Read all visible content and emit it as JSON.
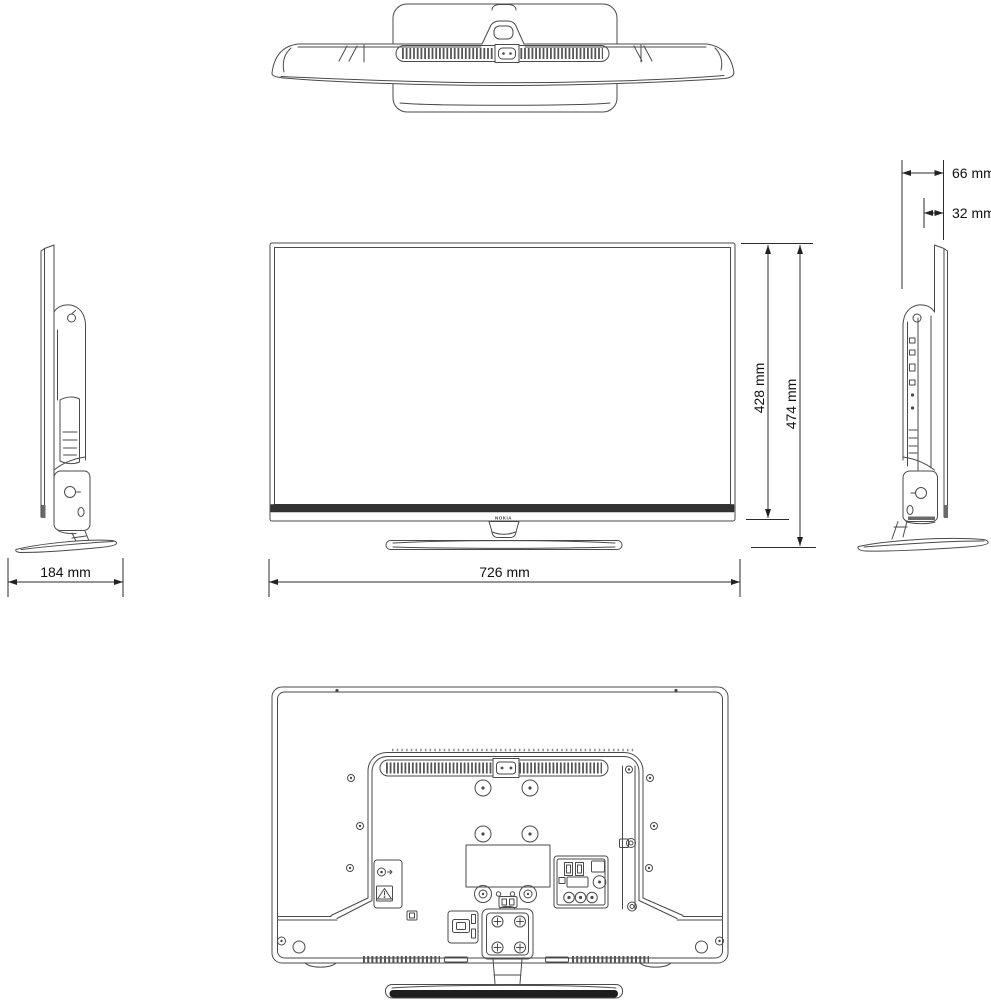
{
  "brand": {
    "logo": "NOKIA"
  },
  "dimensions": {
    "depth_total": "66 mm",
    "depth_panel": "32 mm",
    "height_panel": "428 mm",
    "height_total": "474 mm",
    "stand_depth": "184 mm",
    "width_total": "726 mm"
  },
  "colors": {
    "line": "#4a4a4a",
    "dimension": "#222222",
    "front_bottom_bar": "#323232",
    "stand_strip": "#1e1e1e",
    "background": "#ffffff"
  }
}
